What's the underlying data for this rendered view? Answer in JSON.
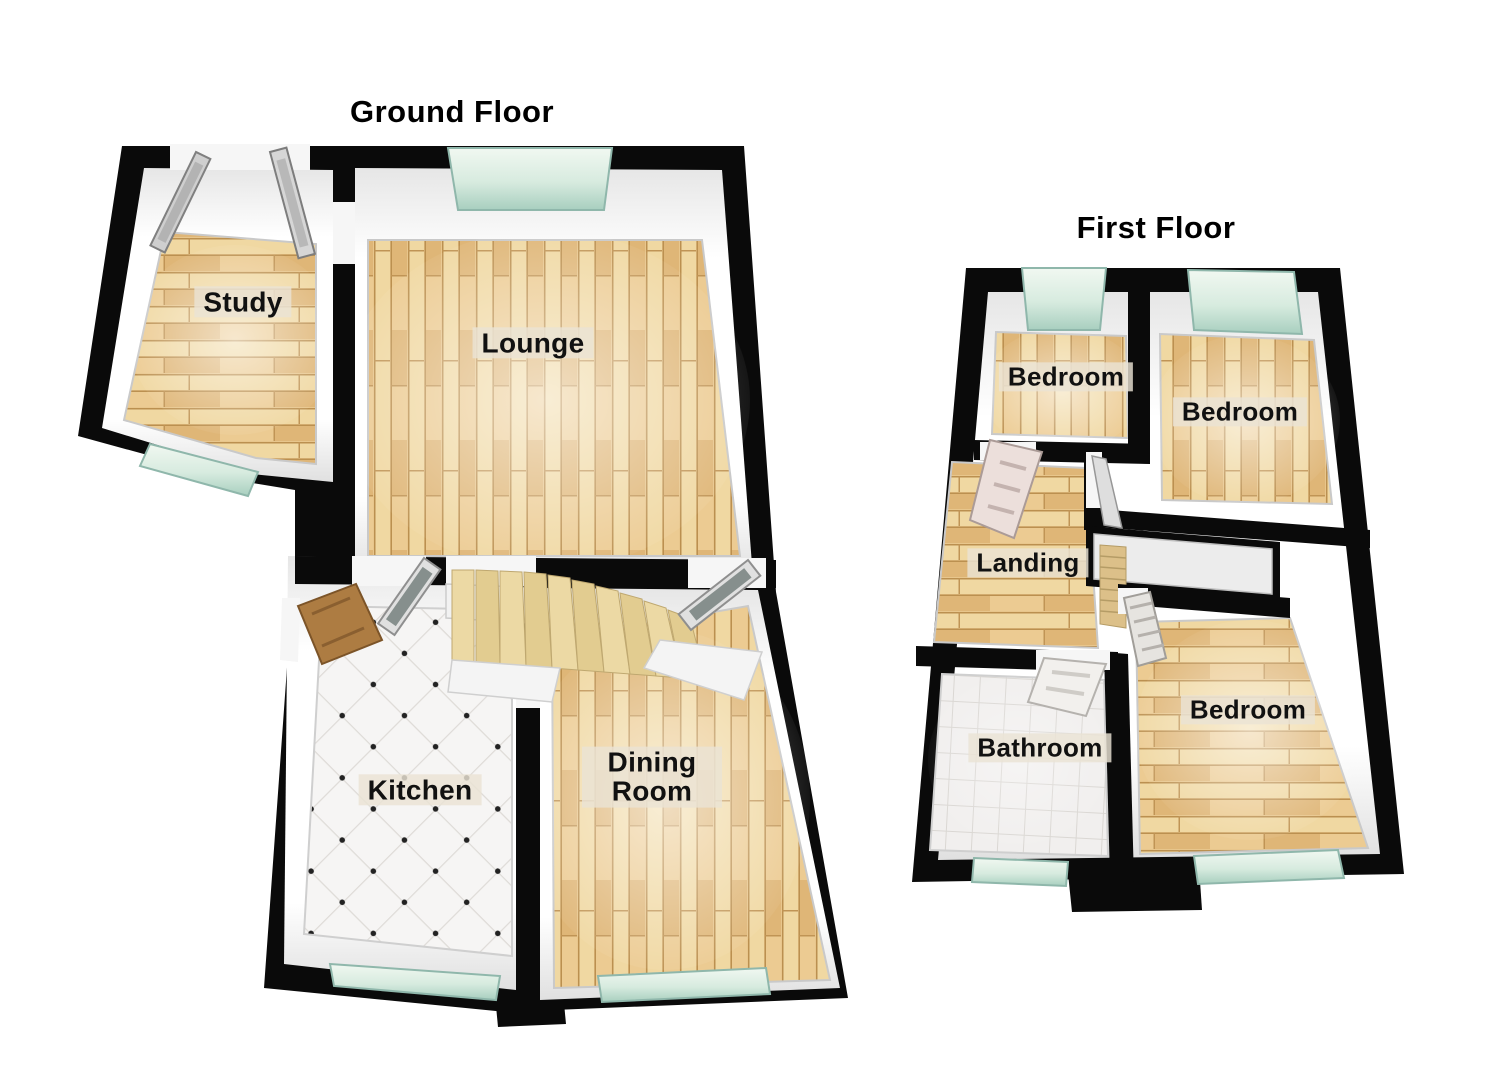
{
  "document": {
    "kind": "property-floorplan",
    "view": "3d-dollhouse"
  },
  "floors": [
    {
      "title": "Ground Floor",
      "rooms": [
        {
          "label": "Study",
          "floor_finish": "wood"
        },
        {
          "label": "Lounge",
          "floor_finish": "wood"
        },
        {
          "label": "Kitchen",
          "floor_finish": "tile"
        },
        {
          "label": "Dining Room",
          "floor_finish": "wood"
        }
      ],
      "features": [
        "staircase",
        "windows",
        "doors"
      ]
    },
    {
      "title": "First Floor",
      "rooms": [
        {
          "label": "Bedroom",
          "floor_finish": "wood"
        },
        {
          "label": "Bedroom",
          "floor_finish": "wood"
        },
        {
          "label": "Landing",
          "floor_finish": "wood"
        },
        {
          "label": "Bathroom",
          "floor_finish": "tile"
        },
        {
          "label": "Bedroom",
          "floor_finish": "wood"
        }
      ],
      "features": [
        "stairwell",
        "windows",
        "doors"
      ]
    }
  ],
  "colors": {
    "wall": "#0a0a0a",
    "inner_wall": "#fbfbfb",
    "wood_base": "#e8c68c",
    "wood_light": "#f0d8a2",
    "wood_dark": "#dfb677",
    "tile": "#f5f4f2",
    "glass": "#cfe7da",
    "stair_tread": "#ead7a0",
    "label_bg": "#eae3d4",
    "text": "#111111"
  }
}
